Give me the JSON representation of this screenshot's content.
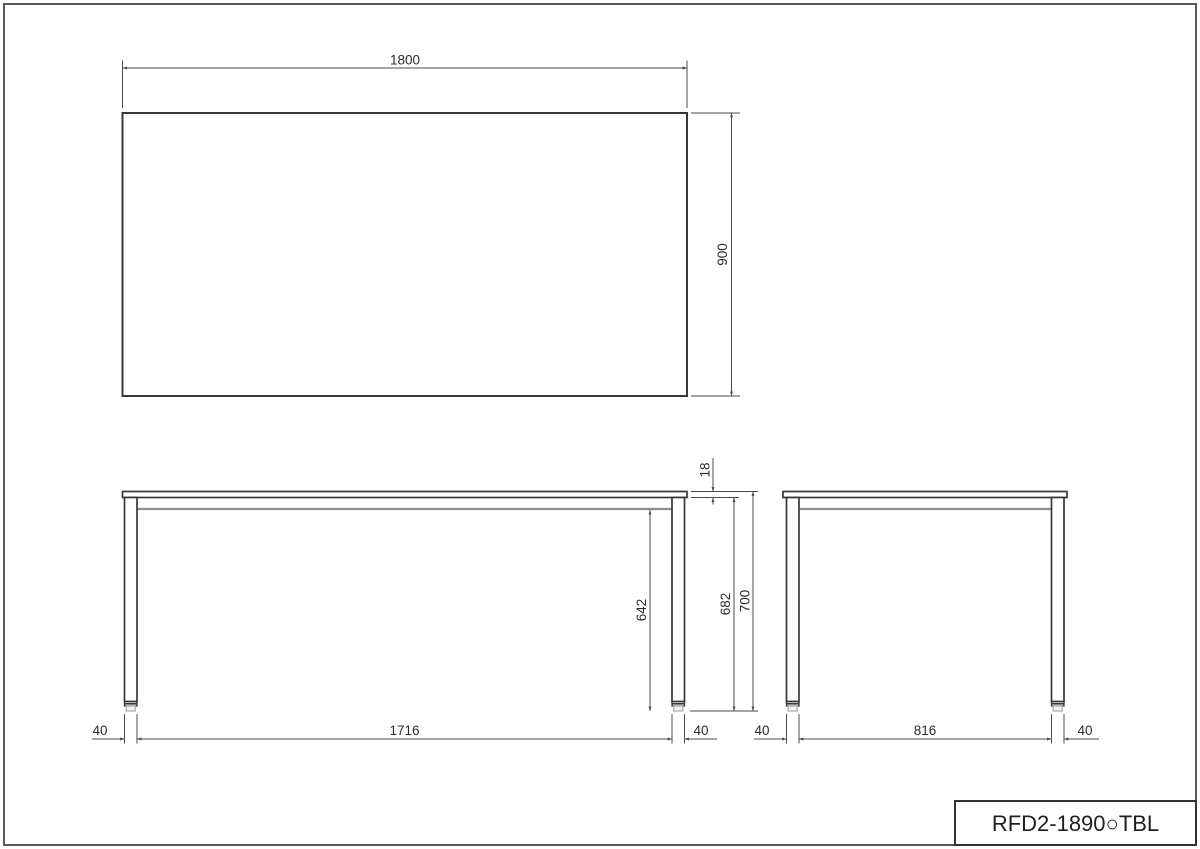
{
  "title_block": {
    "model_code": "RFD2-1890○TBL"
  },
  "views": {
    "top": {
      "width": "1800",
      "depth": "900"
    },
    "front": {
      "top_thickness": "18",
      "height_under_top": "682",
      "overall_height": "700",
      "apron_clearance": "642",
      "left_leg": "40",
      "inner_span": "1716",
      "right_leg": "40"
    },
    "side": {
      "left_leg": "40",
      "inner_span": "816",
      "right_leg": "40"
    }
  },
  "colors": {
    "outline": "#38383a",
    "dimension_line": "#4b4b4d",
    "secondary_line": "#8d8d8f",
    "frame": "#59595b",
    "background": "#ffffff",
    "text": "#2c2c2e"
  }
}
